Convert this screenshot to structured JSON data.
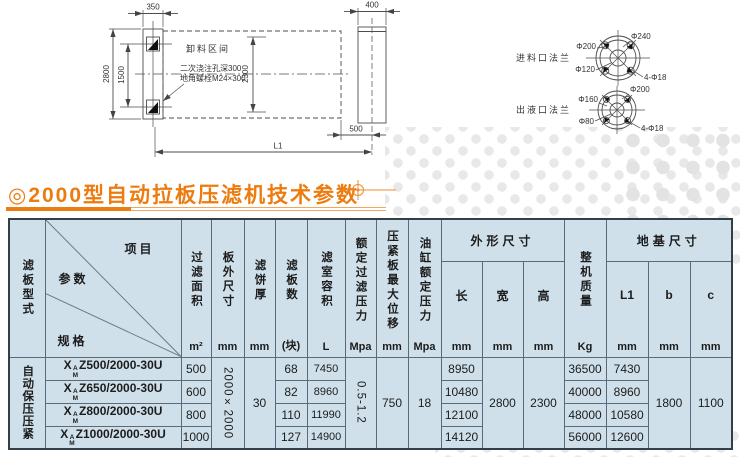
{
  "title": {
    "text": "◎2000型自动拉板压滤机技术参数"
  },
  "colors": {
    "accent_orange": "#ec7c0f",
    "table_bg": "#cfe0ea",
    "line_gray": "#4d4d4d"
  },
  "drawing": {
    "main_view": {
      "dim_350": "350",
      "dim_2800": "2800",
      "dim_1500": "1500",
      "dim_2300": "2300",
      "dim_400": "400",
      "dim_500": "500",
      "dim_L1": "L1",
      "unload_label": "卸料区间",
      "anchor_note_line1": "二次浇注孔深300",
      "anchor_note_line2": "地角螺栓M24×300"
    },
    "feed_flange": {
      "label": "进料口法兰",
      "d_outer": "Φ240",
      "d_bolt_circle": "Φ200",
      "d_inner": "Φ120",
      "d_bolts": "4-Φ18"
    },
    "outlet_flange": {
      "label": "出液口法兰",
      "d_outer": "Φ200",
      "d_bolt_circle": "Φ160",
      "d_inner": "Φ80",
      "d_bolts": "4-Φ18"
    }
  },
  "table": {
    "plate_type": {
      "header": "滤板型式",
      "value": "自动保压压紧"
    },
    "corner": {
      "item": "项目",
      "param": "参数",
      "spec": "规格"
    },
    "model_prefix": {
      "base": "X",
      "sup": "A",
      "sub": "M"
    },
    "cols": {
      "filter_area": {
        "label": "过滤面积",
        "unit": "m²"
      },
      "plate_size": {
        "label": "板外尺寸",
        "unit": "mm"
      },
      "cake_thickness": {
        "label": "滤饼厚",
        "unit": "mm"
      },
      "plate_count": {
        "label": "滤板数",
        "unit": "(块)"
      },
      "chamber_volume": {
        "label": "滤室容积",
        "unit": "L"
      },
      "filter_pressure": {
        "label": "额定过滤压力",
        "unit": "Mpa"
      },
      "max_displacement": {
        "label": "压紧板最大位移",
        "unit": "mm"
      },
      "cylinder_pressure": {
        "label": "油缸额定压力",
        "unit": "Mpa"
      },
      "overall": {
        "label": "外形尺寸",
        "length": {
          "label": "长",
          "unit": "mm"
        },
        "width": {
          "label": "宽",
          "unit": "mm"
        },
        "height": {
          "label": "高",
          "unit": "mm"
        }
      },
      "weight": {
        "label": "整机质量",
        "unit": "Kg"
      },
      "foundation": {
        "label": "地基尺寸",
        "l1": {
          "label": "L1",
          "unit": "mm"
        },
        "b": {
          "label": "b",
          "unit": "mm"
        },
        "c": {
          "label": "c",
          "unit": "mm"
        }
      }
    },
    "merged": {
      "plate_size": "2000×2000",
      "cake_thickness": "30",
      "filter_pressure": "0.5-1.2",
      "max_displacement": "750",
      "cylinder_pressure": "18",
      "width": "2800",
      "height": "2300",
      "b": "1800",
      "c": "1100"
    },
    "rows": [
      {
        "model": "Z500/2000-30U",
        "area": "500",
        "plates": "68",
        "volume": "7450",
        "length": "8950",
        "weight": "36500",
        "l1": "7430"
      },
      {
        "model": "Z650/2000-30U",
        "area": "600",
        "plates": "82",
        "volume": "8960",
        "length": "10480",
        "weight": "40000",
        "l1": "8960"
      },
      {
        "model": "Z800/2000-30U",
        "area": "800",
        "plates": "110",
        "volume": "11990",
        "length": "12100",
        "weight": "48000",
        "l1": "10580"
      },
      {
        "model": "Z1000/2000-30U",
        "area": "1000",
        "plates": "127",
        "volume": "14900",
        "length": "14120",
        "weight": "56000",
        "l1": "12600"
      }
    ]
  }
}
